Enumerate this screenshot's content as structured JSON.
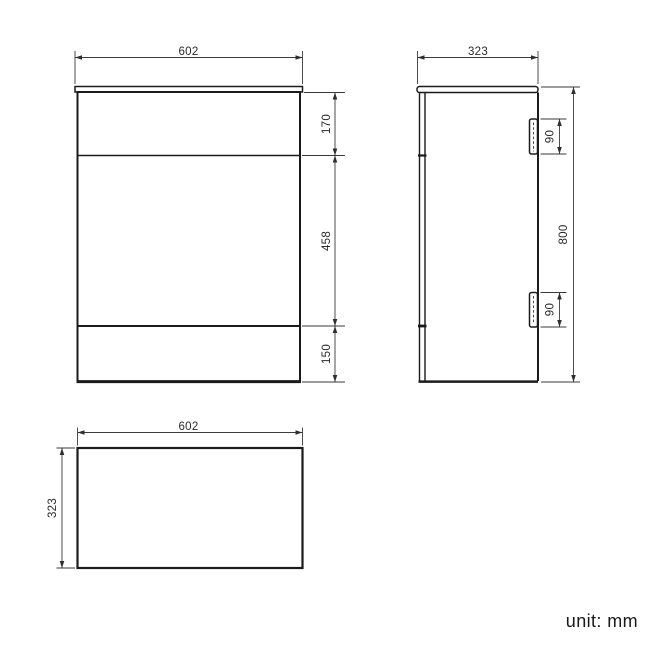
{
  "document": {
    "type": "technical-dimension-drawing",
    "subject": "bathroom vanity / WC unit, three orthographic views",
    "unit_note": "unit: mm"
  },
  "colors": {
    "background": "#ffffff",
    "outline": "#1b1b1b",
    "dimension_lines": "#3a3a3a",
    "text": "#2b2b2b"
  },
  "front_view": {
    "width": "602",
    "top_section_height": "170",
    "door_section_height": "458",
    "plinth_height": "150"
  },
  "side_view": {
    "depth": "323",
    "overall_height": "800",
    "top_hinge_height": "90",
    "bottom_hinge_height": "90"
  },
  "top_view": {
    "width": "602",
    "depth": "323"
  }
}
